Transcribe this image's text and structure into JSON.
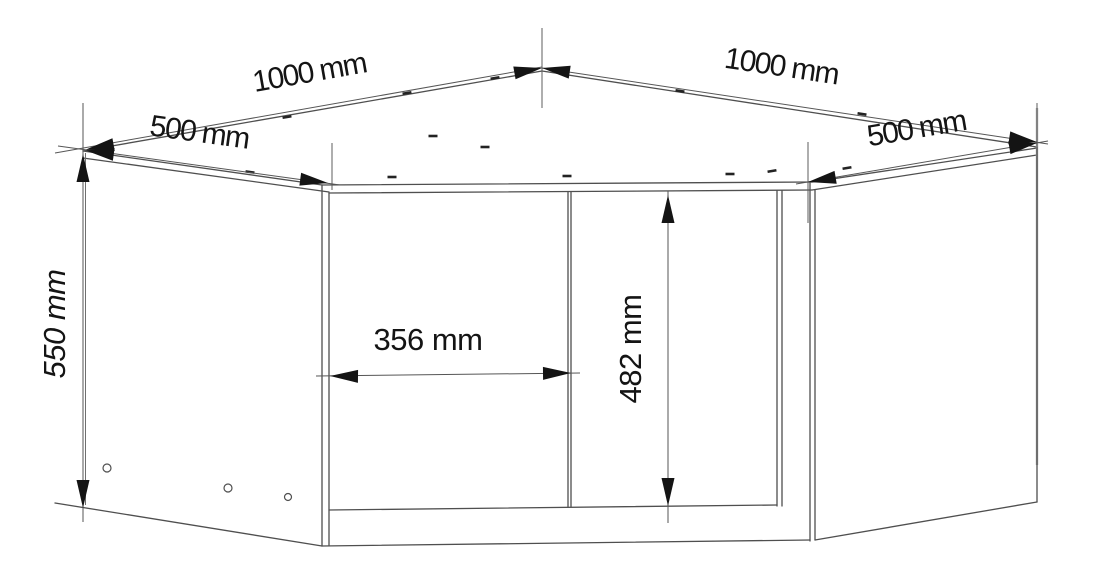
{
  "diagram": {
    "type": "technical-dimension-drawing",
    "subject": "corner wall cabinet",
    "units": "mm",
    "background_color": "#ffffff",
    "line_color": "#4f4f4f",
    "arrow_color": "#141414",
    "dimensions": {
      "back_left_width": {
        "label": "1000 mm",
        "value": 1000
      },
      "back_right_width": {
        "label": "1000 mm",
        "value": 1000
      },
      "left_side_depth": {
        "label": "500 mm",
        "value": 500
      },
      "right_side_depth": {
        "label": "500 mm",
        "value": 500
      },
      "height": {
        "label": "550 mm",
        "value": 550
      },
      "door_width": {
        "label": "356 mm",
        "value": 356
      },
      "door_height": {
        "label": "482 mm",
        "value": 482
      }
    }
  }
}
